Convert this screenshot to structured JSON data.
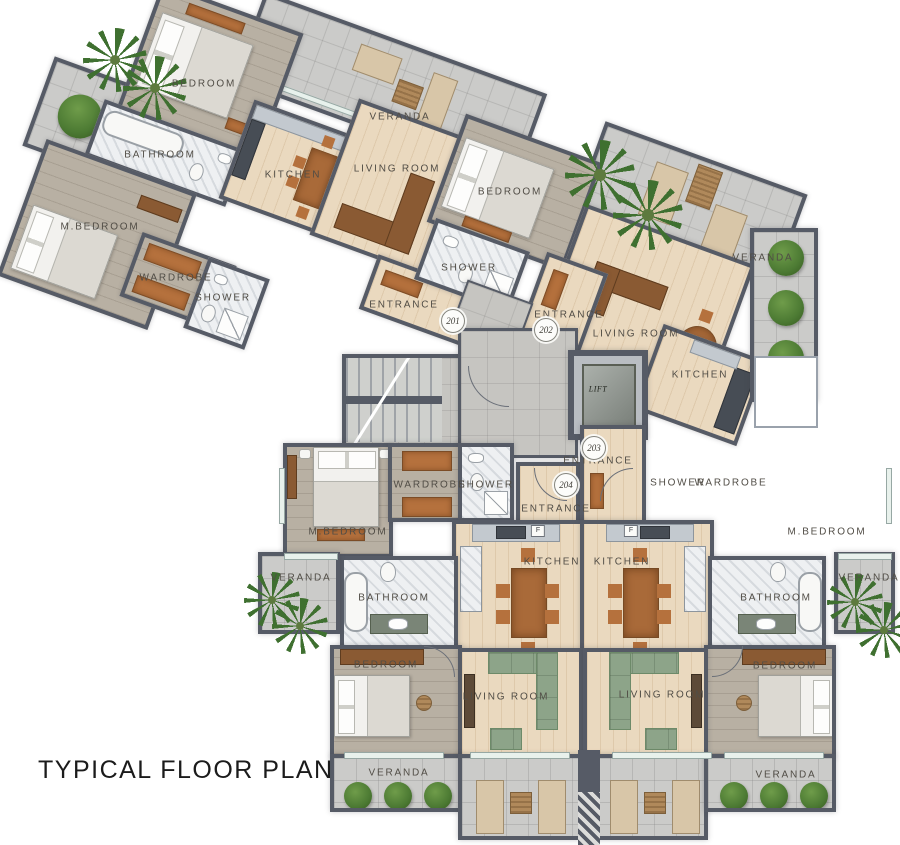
{
  "title": "TYPICAL FLOOR PLAN",
  "core": {
    "lift": "LIFT"
  },
  "units": {
    "u201": {
      "badge": "201",
      "bedroom": "BEDROOM",
      "veranda": "VERANDA",
      "bathroom": "BATHROOM",
      "m_bedroom": "M.BEDROOM",
      "wardrobe": "WARDROBE",
      "shower": "SHOWER",
      "kitchen": "KITCHEN",
      "living": "LIVING ROOM",
      "entrance": "ENTRANCE"
    },
    "u202": {
      "badge": "202",
      "bedroom": "BEDROOM",
      "shower": "SHOWER",
      "entrance": "ENTRANCE",
      "kitchen": "KITCHEN",
      "living": "LIVING ROOM",
      "veranda": "VERANDA"
    },
    "u203": {
      "badge": "203",
      "entrance": "ENTRANCE",
      "shower": "SHOWER",
      "wardrobe": "WARDROBE",
      "m_bedroom": "M.BEDROOM",
      "kitchen": "KITCHEN",
      "bathroom": "BATHROOM",
      "veranda_side": "VERANDA",
      "bedroom": "BEDROOM",
      "living": "LIVING ROOM",
      "veranda_bottom": "VERANDA",
      "fridge": "F"
    },
    "u204": {
      "badge": "204",
      "wardrobe": "WARDROBE",
      "shower": "SHOWER",
      "entrance": "ENTRANCE",
      "m_bedroom": "M.BEDROOM",
      "kitchen": "KITCHEN",
      "bathroom": "BATHROOM",
      "veranda_side": "VERANDA",
      "bedroom": "BEDROOM",
      "living": "LIVING ROOM",
      "veranda_bottom": "VERANDA",
      "fridge": "F"
    }
  },
  "colors": {
    "wall": "#565b66",
    "wood_light": "#ead9bf",
    "wood_gray": "#b8b0a3",
    "tile": "#cbcbc9",
    "marble": "#eef0f2",
    "accent_wood": "#b5713d",
    "sofa_green": "#8da489",
    "plant_green": "#4c7a36"
  },
  "icons": {
    "plants": [
      "palm-icon",
      "bush-icon",
      "round-tree-icon"
    ]
  }
}
